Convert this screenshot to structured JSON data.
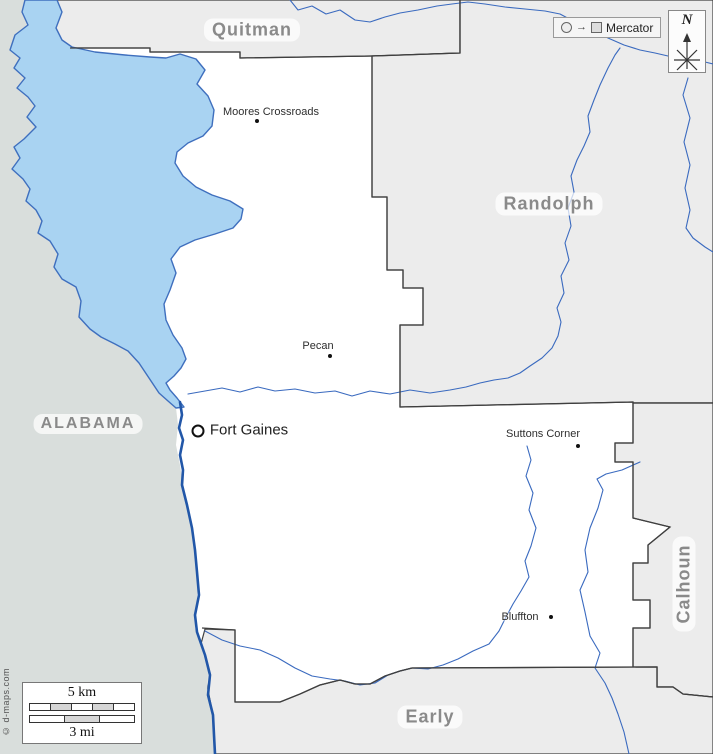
{
  "map": {
    "regions": {
      "state_left": "ALABAMA",
      "county_top": "Quitman",
      "county_right_top": "Randolph",
      "county_right": "Calhoun",
      "county_bottom": "Early"
    },
    "towns": [
      {
        "name": "Moores Crossroads"
      },
      {
        "name": "Pecan"
      },
      {
        "name": "Fort Gaines"
      },
      {
        "name": "Suttons Corner"
      },
      {
        "name": "Bluffton"
      }
    ],
    "projection_badge": "Mercator",
    "compass_letter": "N",
    "scale": {
      "km": "5 km",
      "mi": "3 mi"
    },
    "watermark": "© d-maps.com",
    "colors": {
      "lake_fill": "#a9d3f2",
      "lake_border": "#3f6fbe",
      "river": "#2257a8",
      "creek": "#3a6abf",
      "county_fill": "#ececec",
      "alabama_fill": "#d9dedc",
      "clay_fill": "#ffffff",
      "boundary": "#3f3f3f",
      "label_gray": "#8a8a8a"
    }
  }
}
